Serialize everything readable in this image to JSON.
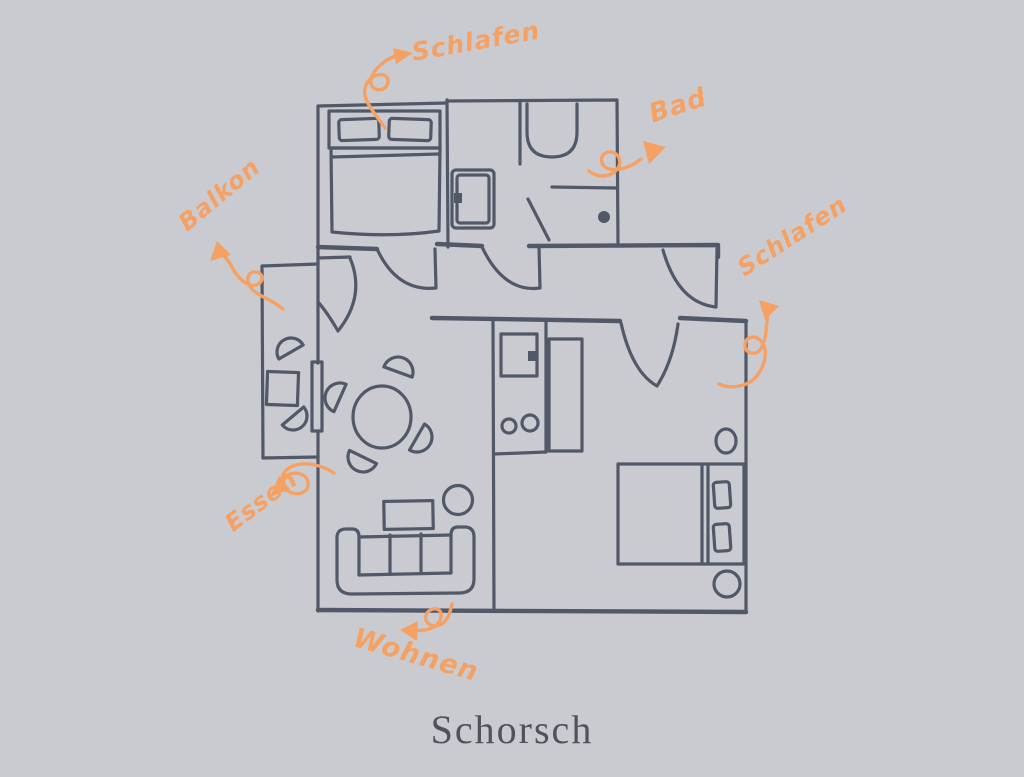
{
  "title": {
    "text": "Schorsch"
  },
  "labels": {
    "schlafen_top": "Schlafen",
    "bad": "Bad",
    "balkon": "Balkon",
    "schlafen_right": "Schlafen",
    "essen": "Essen",
    "wohnen": "Wohnen"
  },
  "colors": {
    "background": "#c9cbd1",
    "wall": "#515868",
    "accent_orange": "#f5a164",
    "title_text": "#4e545e"
  },
  "floorplan": {
    "furniture_icons": [
      "double-bed-icon",
      "pillow-icon",
      "bathtub-icon",
      "shower-icon",
      "washing-machine-icon",
      "kitchen-counter-icon",
      "stove-burners-icon",
      "wardrobe-icon",
      "round-dining-table-icon",
      "chair-icon",
      "sofa-icon",
      "coffee-table-icon",
      "side-table-icon",
      "balcony-table-icon",
      "nightstand-icon",
      "door-swing-icon",
      "balcony-door-icon"
    ],
    "annotation_arrows": [
      "arrow-to-schlafen-top",
      "arrow-to-bad",
      "arrow-to-balkon",
      "arrow-to-schlafen-right",
      "arrow-to-essen",
      "arrow-to-wohnen"
    ]
  }
}
